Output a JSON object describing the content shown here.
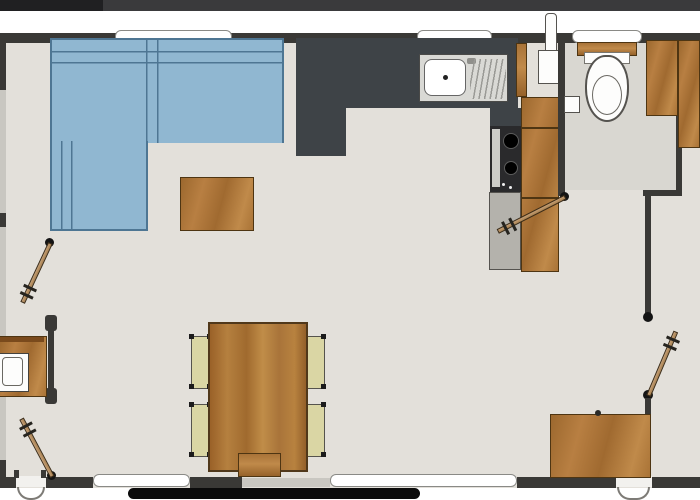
{
  "plan": {
    "type": "floor-plan",
    "visible_text": "",
    "counts": {
      "top_windows": 3,
      "bottom_windows": 2,
      "interior_doors": 4,
      "exterior_door_arcs": 2,
      "dining_chairs": 4,
      "wardrobes": 2,
      "hob_burners": 2
    }
  },
  "palette": {
    "background": "#ffffff",
    "header_bar": "#3a3a3c",
    "header_bar_dark": "#202022",
    "wall": "#3a3936",
    "floor": "#e3e0da",
    "bathroom_floor": "#d9d7d1",
    "wood": "#b07a3e",
    "sofa_blue": "#90b7d1",
    "sofa_outline": "#4e7693",
    "chair_seat": "#dad6a4",
    "counter_charcoal": "#3e4347",
    "appliance_gray": "#b4b2ac",
    "door_leaf_tan": "#b79064",
    "bottom_bar_black": "#0b0b0b"
  },
  "items": {
    "sofa": "Corner sofa",
    "coffee_table": "Coffee table",
    "side_cabinet": "Side cabinet",
    "kitchen_counter": "Kitchen counter",
    "sink": "Kitchen sink with drainboard",
    "hob": "Two-burner hob",
    "appliance_cabinet": "Appliance cabinet",
    "tall_cabinet": "Tall kitchen cabinet",
    "boiler": "Water heater",
    "toilet": "Toilet",
    "cistern_shelf": "Cistern shelf",
    "paper_holder": "Paper holder",
    "wardrobe": "Wardrobe",
    "dresser": "Dresser",
    "vanity": "Vanity unit with basin",
    "dining_table": "Dining table",
    "dining_chair": "Dining chair",
    "bench": "Bench",
    "door": "Interior door",
    "entry_arc": "Entry door swing",
    "window": "Window"
  }
}
